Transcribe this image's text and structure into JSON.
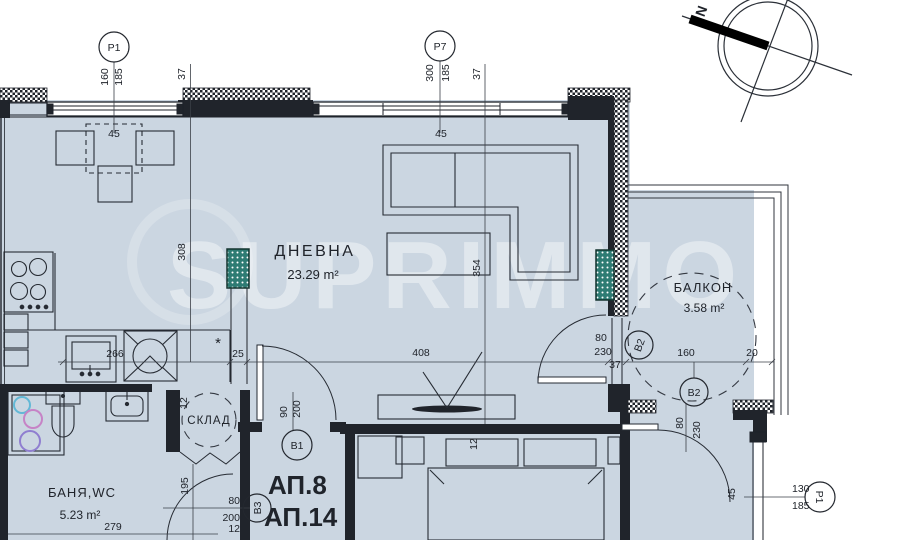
{
  "watermark": {
    "text": "SUPRIMMO"
  },
  "compass": {
    "north": "N"
  },
  "rooms": {
    "living": {
      "name": "ДНЕВНА",
      "area": "23.29 m²"
    },
    "balcony": {
      "name": "БАЛКОН",
      "area": "3.58 m²"
    },
    "bath": {
      "name": "БАНЯ,WC",
      "area": "5.23 m²"
    },
    "storage": {
      "name": "СКЛАД"
    },
    "unit": {
      "line1": "АП.8",
      "line2": "АП.14",
      "area_clipped": "23.44 m²"
    }
  },
  "markers": {
    "p1_top": "P1",
    "p7": "P7",
    "b1": "B1",
    "b2_wall": "B2",
    "b2_low": "B2",
    "b3": "B3",
    "p1_right": "P1"
  },
  "dims": {
    "p1_a": "160",
    "p1_b": "185",
    "p1_c": "37",
    "win_a": "45",
    "p7_a": "300",
    "p7_b": "185",
    "p7_c": "37",
    "win_b": "45",
    "lr_left": "308",
    "lr_right": "354",
    "row_266": "266",
    "row_25": "25",
    "row_408": "408",
    "bd_80": "80",
    "bd_230": "230",
    "bd_37": "37",
    "balc_160": "160",
    "balc_20": "20",
    "door_90": "90",
    "door_200": "200",
    "st_12": "12",
    "bath_195": "195",
    "bath_80": "80",
    "bath_200": "200",
    "bath_12": "12",
    "bath_279": "279",
    "bed_12": "12",
    "r_80": "80",
    "r_230": "230",
    "r_45": "45",
    "r_130": "130",
    "r_185": "185",
    "star": "*"
  }
}
